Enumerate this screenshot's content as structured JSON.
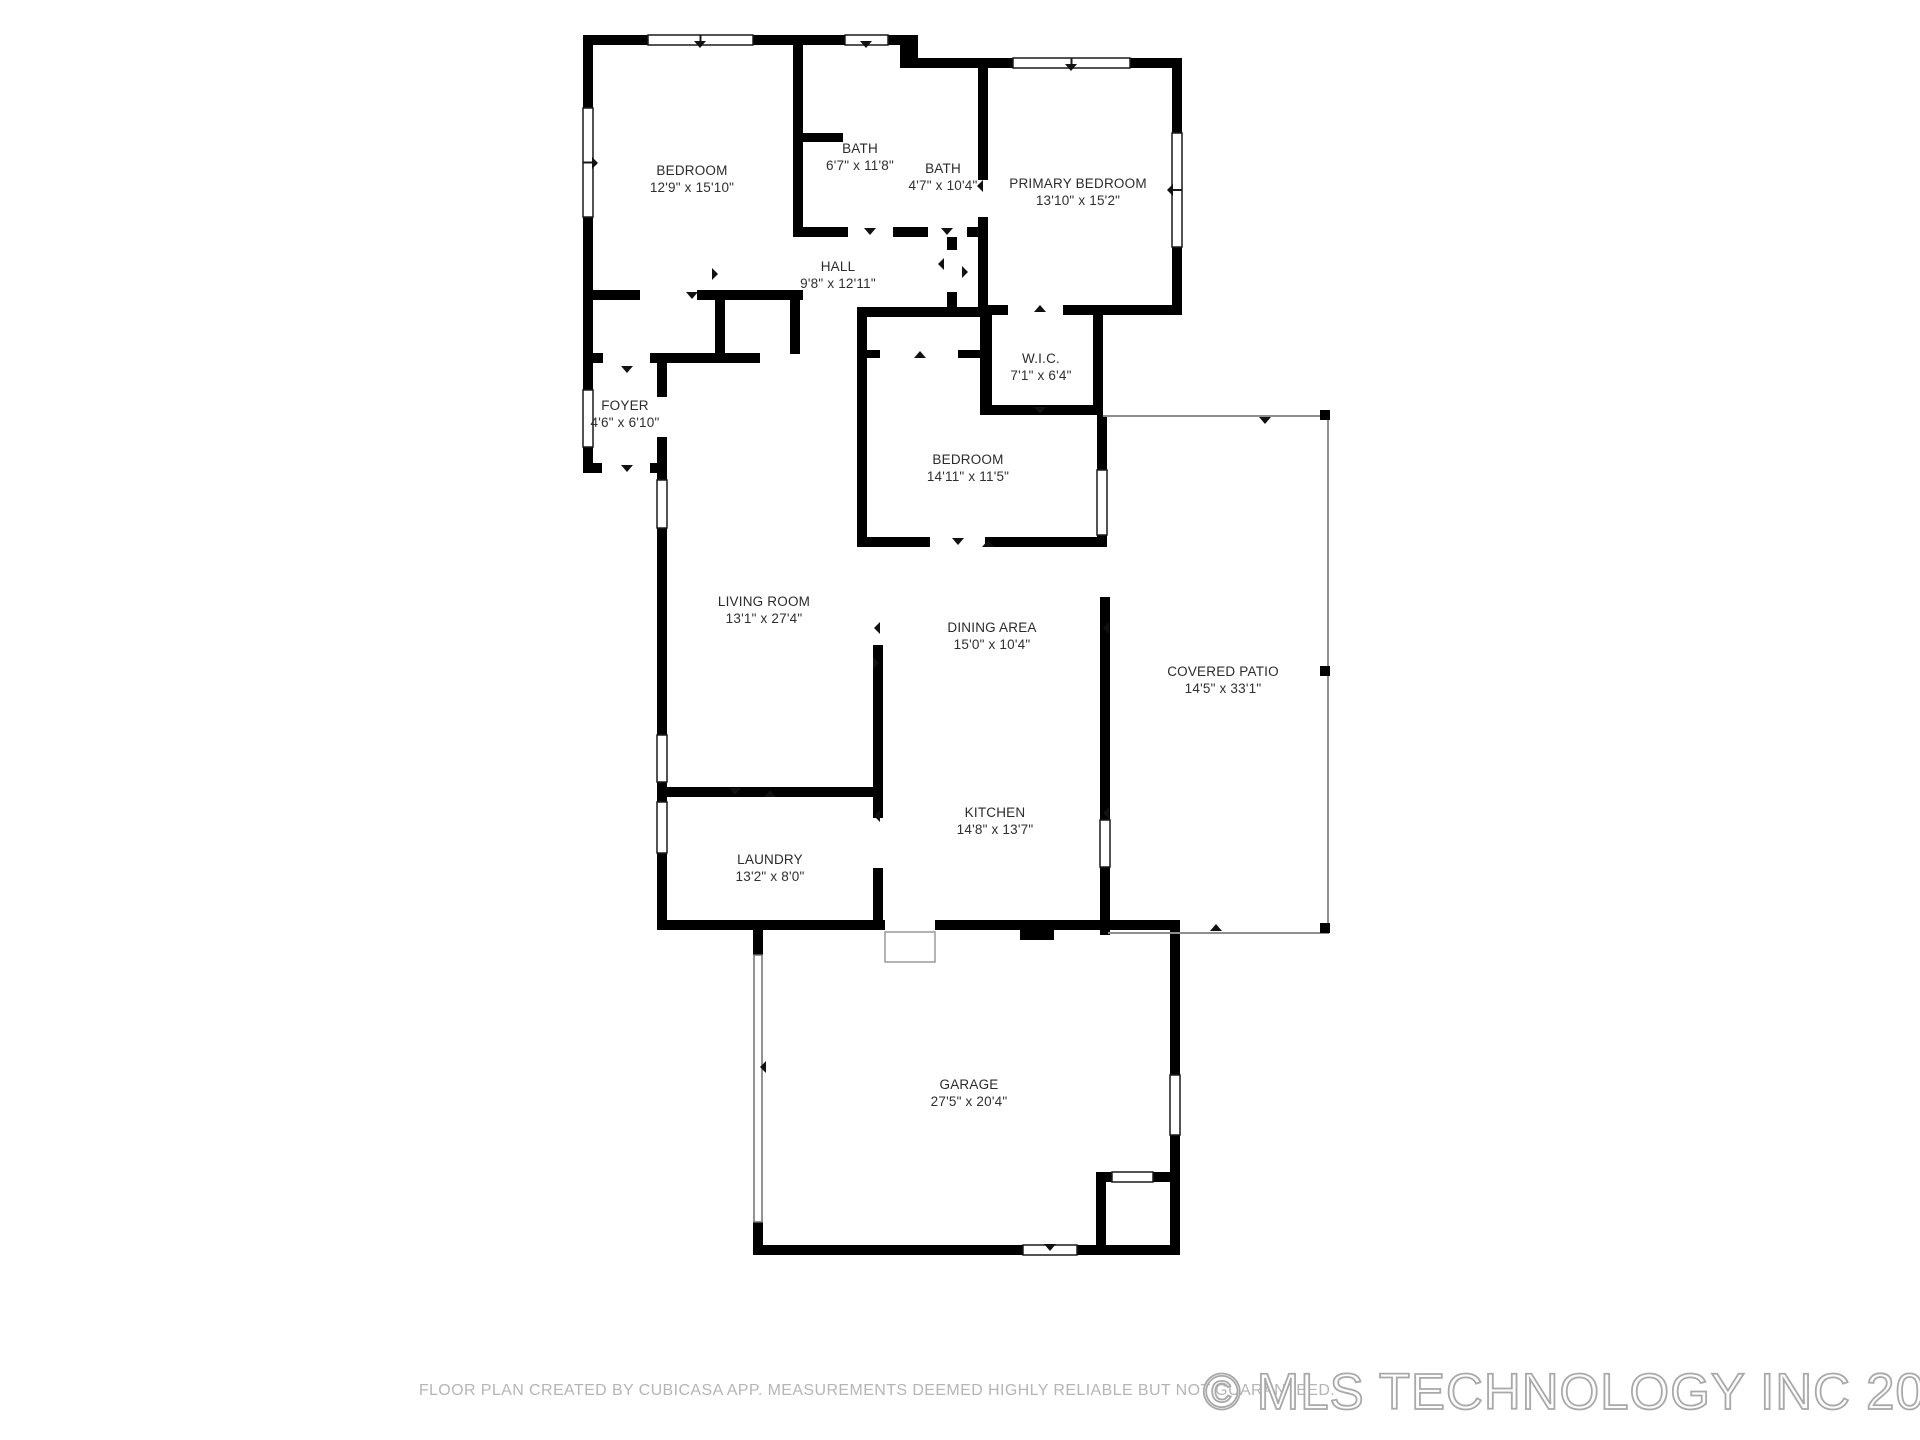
{
  "page": {
    "background": "#ffffff",
    "wall_color": "#000000",
    "window_frame_color": "#1a1a1a",
    "patio_line_color": "#8f8f8f"
  },
  "floor_plan": {
    "rooms": [
      {
        "id": "bedroom-1",
        "name": "BEDROOM",
        "dimensions": "12'9\" x 15'10\"",
        "label_x": 692,
        "label_y": 171
      },
      {
        "id": "bath-1",
        "name": "BATH",
        "dimensions": "6'7\" x 11'8\"",
        "label_x": 860,
        "label_y": 149
      },
      {
        "id": "bath-2",
        "name": "BATH",
        "dimensions": "4'7\" x 10'4\"",
        "label_x": 943,
        "label_y": 169
      },
      {
        "id": "primary-bedroom",
        "name": "PRIMARY BEDROOM",
        "dimensions": "13'10\" x 15'2\"",
        "label_x": 1078,
        "label_y": 184
      },
      {
        "id": "hall",
        "name": "HALL",
        "dimensions": "9'8\" x 12'11\"",
        "label_x": 838,
        "label_y": 267
      },
      {
        "id": "wic",
        "name": "W.I.C.",
        "dimensions": "7'1\" x 6'4\"",
        "label_x": 1041,
        "label_y": 359
      },
      {
        "id": "foyer",
        "name": "FOYER",
        "dimensions": "4'6\" x 6'10\"",
        "label_x": 625,
        "label_y": 406
      },
      {
        "id": "bedroom-2",
        "name": "BEDROOM",
        "dimensions": "14'11\" x 11'5\"",
        "label_x": 968,
        "label_y": 460
      },
      {
        "id": "living-room",
        "name": "LIVING ROOM",
        "dimensions": "13'1\" x 27'4\"",
        "label_x": 764,
        "label_y": 602
      },
      {
        "id": "dining-area",
        "name": "DINING AREA",
        "dimensions": "15'0\" x 10'4\"",
        "label_x": 992,
        "label_y": 628
      },
      {
        "id": "covered-patio",
        "name": "COVERED PATIO",
        "dimensions": "14'5\" x 33'1\"",
        "label_x": 1223,
        "label_y": 672
      },
      {
        "id": "kitchen",
        "name": "KITCHEN",
        "dimensions": "14'8\" x 13'7\"",
        "label_x": 995,
        "label_y": 813
      },
      {
        "id": "laundry",
        "name": "LAUNDRY",
        "dimensions": "13'2\" x 8'0\"",
        "label_x": 770,
        "label_y": 860
      },
      {
        "id": "garage",
        "name": "GARAGE",
        "dimensions": "27'5\" x 20'4\"",
        "label_x": 969,
        "label_y": 1085
      }
    ]
  },
  "footer": {
    "disclaimer": "FLOOR PLAN CREATED BY CUBICASA APP. MEASUREMENTS DEEMED HIGHLY RELIABLE BUT NOT GUARANTEED.",
    "watermark": "© MLS TECHNOLOGY INC 2025"
  }
}
